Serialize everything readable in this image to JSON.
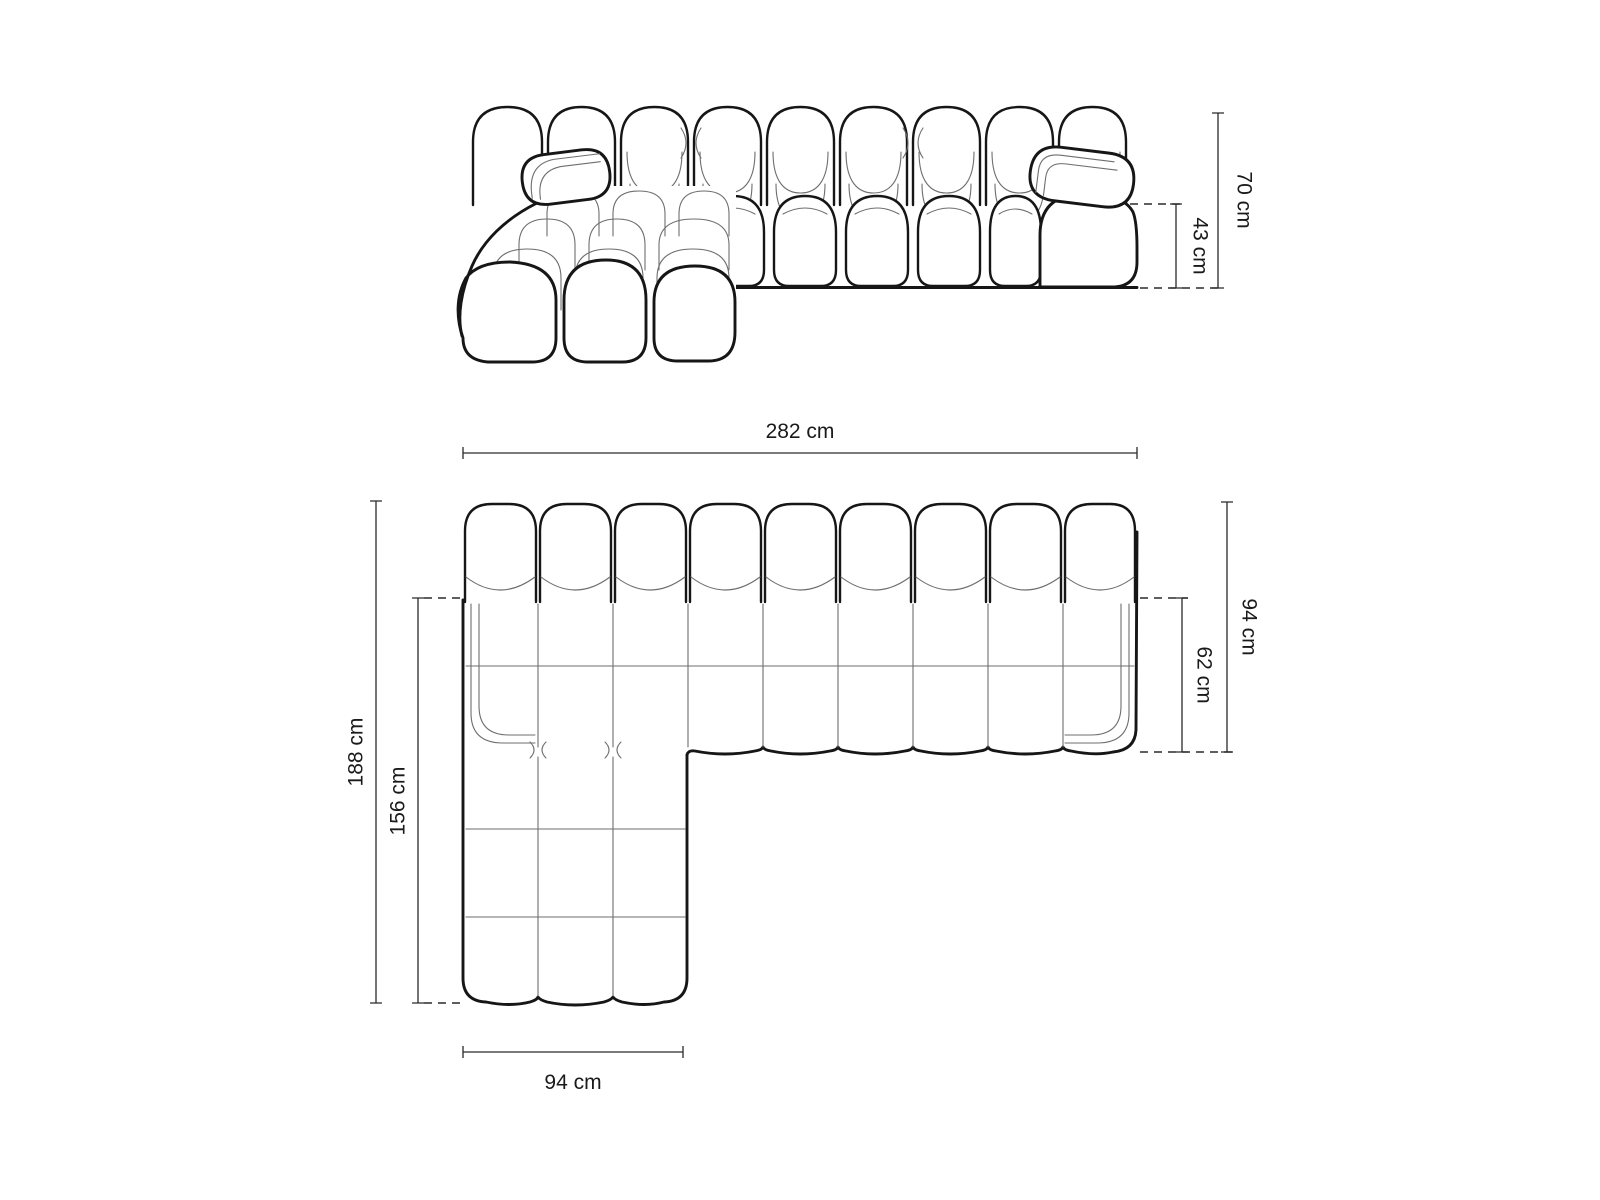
{
  "diagram": {
    "type": "sofa-dimension-drawing",
    "front_view": {
      "total_height": "70 cm",
      "seat_height": "43 cm"
    },
    "top_view": {
      "total_width": "282 cm",
      "total_depth_right": "94 cm",
      "seat_depth_right": "62 cm",
      "total_depth_left": "188 cm",
      "chaise_depth": "156 cm",
      "chaise_width": "94 cm"
    },
    "colors": {
      "outline": "#161616",
      "inner_line": "#6e6e6e",
      "dimension_line": "#2a2a2a",
      "text": "#1a1a1a",
      "background": "#ffffff"
    }
  }
}
